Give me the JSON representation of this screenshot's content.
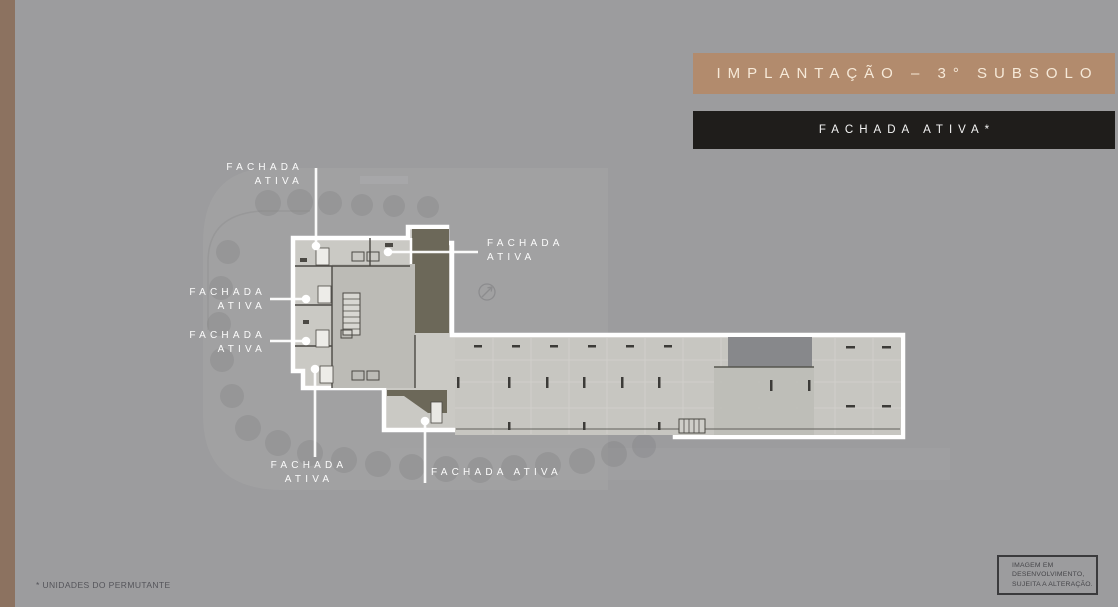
{
  "theme": {
    "background": "#9c9c9e",
    "left_stripe": "#8c7260",
    "title_banner_bg": "#b28b6d",
    "title_text_color": "#f6e9d8",
    "subtitle_banner_bg": "#1f1d1b",
    "subtitle_text_color": "#f4f4f4",
    "plan_fill": "#cac9c4",
    "plan_outline": "#ffffff",
    "ramp_fill": "#6c6859",
    "label_text_color": "#fbfbfb"
  },
  "header": {
    "title": "IMPLANTAÇÃO – 3° SUBSOLO",
    "subtitle": "FACHADA ATIVA*"
  },
  "plan": {
    "labels": [
      {
        "id": "top-left",
        "line1": "FACHADA",
        "line2": "ATIVA"
      },
      {
        "id": "left-upper",
        "line1": "FACHADA",
        "line2": "ATIVA"
      },
      {
        "id": "left-lower",
        "line1": "FACHADA",
        "line2": "ATIVA"
      },
      {
        "id": "top-right",
        "line1": "FACHADA",
        "line2": "ATIVA"
      },
      {
        "id": "bottom-left",
        "line1": "FACHADA",
        "line2": "ATIVA"
      },
      {
        "id": "bottom-center",
        "line1": "FACHADA ATIVA",
        "line2": ""
      }
    ],
    "icons": [
      "compass-icon"
    ]
  },
  "footnote": "* UNIDADES DO PERMUTANTE",
  "disclaimer": {
    "lines": [
      "IMAGEM EM",
      "DESENVOLVIMENTO,",
      "SUJEITA A ALTERAÇÃO."
    ]
  }
}
